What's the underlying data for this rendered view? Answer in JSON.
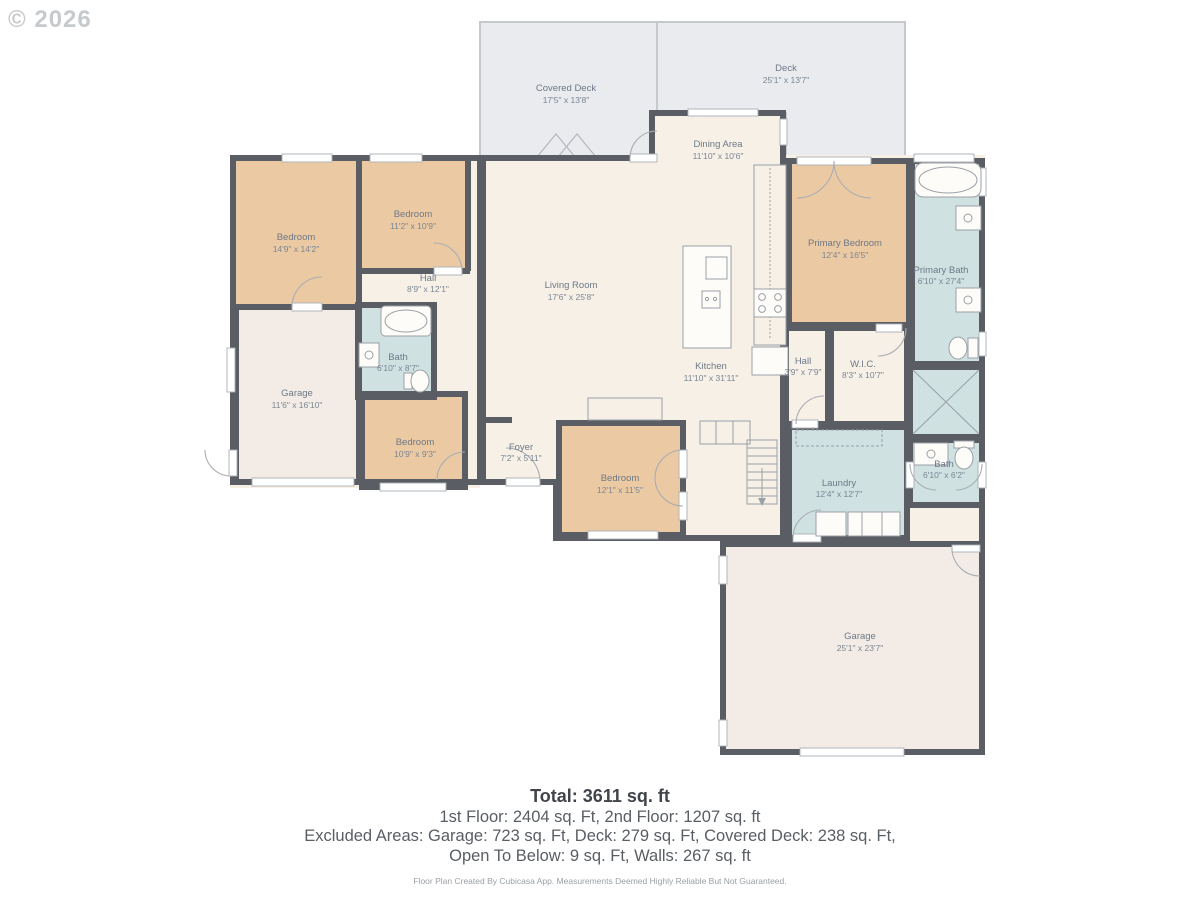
{
  "watermark": "© 2026",
  "colors": {
    "wall": "#5a5e64",
    "floor_cream": "#f7f0e7",
    "room_peach": "#ebc9a3",
    "room_blue": "#cfe1e1",
    "deck_gray": "#e9ebee",
    "garage_fill": "#f3ece6",
    "fixture_stroke": "#9aa0a6",
    "label": "#6e7987"
  },
  "rooms": {
    "covered_deck": {
      "label": "Covered Deck",
      "dims": "17'5\" x 13'8\""
    },
    "deck": {
      "label": "Deck",
      "dims": "25'1\" x 13'7\""
    },
    "dining": {
      "label": "Dining Area",
      "dims": "11'10\" x 10'6\""
    },
    "bedroom1": {
      "label": "Bedroom",
      "dims": "14'9\" x 14'2\""
    },
    "bedroom2": {
      "label": "Bedroom",
      "dims": "11'2\" x 10'9\""
    },
    "hall1": {
      "label": "Hall",
      "dims": "8'9\" x 12'1\""
    },
    "living_room": {
      "label": "Living Room",
      "dims": "17'6\" x 25'8\""
    },
    "primary_bedroom": {
      "label": "Primary Bedroom",
      "dims": "12'4\" x 16'5\""
    },
    "primary_bath": {
      "label": "Primary Bath",
      "dims": "6'10\" x 27'4\""
    },
    "bath1": {
      "label": "Bath",
      "dims": "6'10\" x 8'7\""
    },
    "garage1": {
      "label": "Garage",
      "dims": "11'6\" x 16'10\""
    },
    "bedroom3": {
      "label": "Bedroom",
      "dims": "10'9\" x 9'3\""
    },
    "foyer": {
      "label": "Foyer",
      "dims": "7'2\" x 5'11\""
    },
    "bedroom4": {
      "label": "Bedroom",
      "dims": "12'1\" x 11'5\""
    },
    "kitchen": {
      "label": "Kitchen",
      "dims": "11'10\" x 31'11\""
    },
    "hall2": {
      "label": "Hall",
      "dims": "3'9\" x 7'9\""
    },
    "wic": {
      "label": "W.I.C.",
      "dims": "8'3\" x 10'7\""
    },
    "laundry": {
      "label": "Laundry",
      "dims": "12'4\" x 12'7\""
    },
    "bath2": {
      "label": "Bath",
      "dims": "6'10\" x 6'2\""
    },
    "garage2": {
      "label": "Garage",
      "dims": "25'1\" x 23'7\""
    }
  },
  "footer": {
    "total": "Total: 3611 sq. ft",
    "floors": "1st Floor: 2404 sq. Ft, 2nd Floor: 1207 sq. ft",
    "excluded1": "Excluded Areas: Garage: 723 sq. Ft, Deck: 279 sq. Ft, Covered Deck: 238 sq. Ft,",
    "excluded2": "Open To Below: 9 sq. Ft, Walls: 267 sq. ft",
    "disclaimer": "Floor Plan Created By Cubicasa App. Measurements Deemed Highly Reliable But Not Guaranteed."
  }
}
